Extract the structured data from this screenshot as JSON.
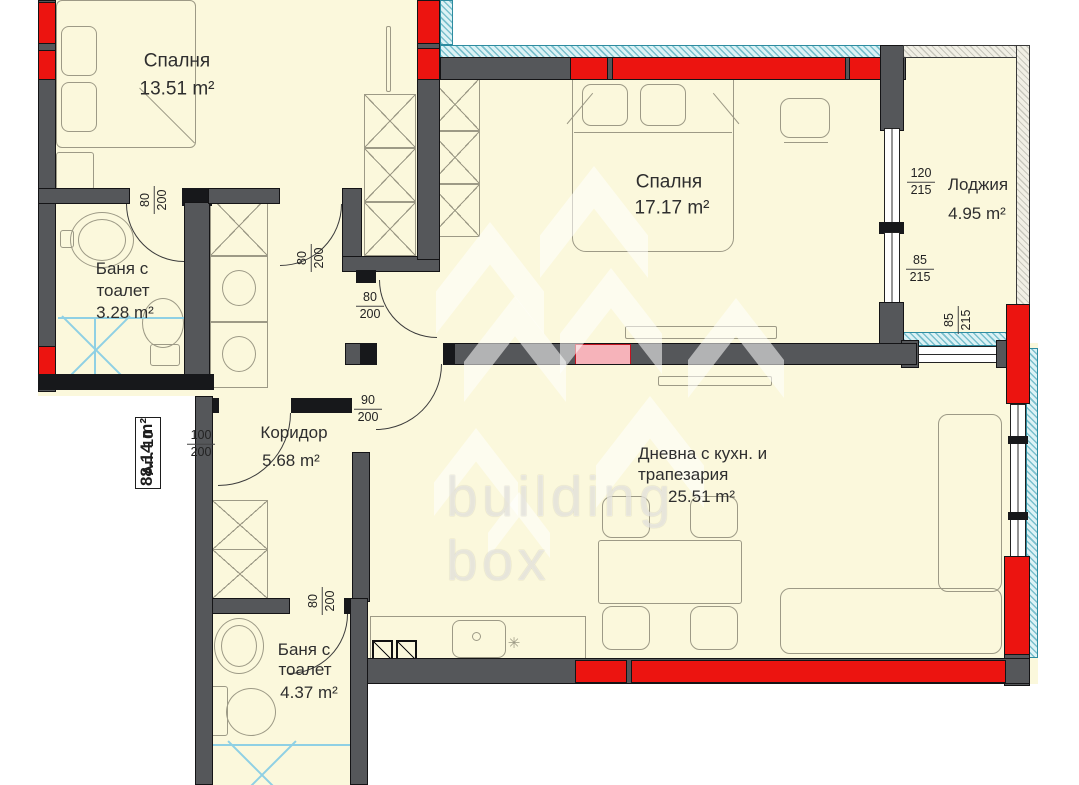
{
  "title": "Апартамент 10 — разпределение",
  "colors": {
    "floor": "#FBF8DC",
    "wall_gray": "#55575A",
    "column_red": "#EC1410",
    "insulation_teal": "#2E8CA0",
    "highlight_pink": "#F6B3BA",
    "plumbing_blue": "#8FD0E4"
  },
  "apartment": {
    "number": "Ап. 10",
    "area": "88.14 m²"
  },
  "rooms": [
    {
      "name": "Спалня",
      "area": "13.51 m²"
    },
    {
      "name": "Спалня",
      "area": "17.17 m²"
    },
    {
      "name": "Лоджия",
      "area": "4.95 m²"
    },
    {
      "name_line1": "Баня с",
      "name_line2": "тоалет",
      "area": "3.28 m²"
    },
    {
      "name": "Коридор",
      "area": "5.68 m²"
    },
    {
      "name_line1": "Дневна с кухн. и",
      "name_line2": "трапезария",
      "area": "25.51 m²"
    },
    {
      "name_line1": "Баня с",
      "name_line2": "тоалет",
      "area": "4.37 m²"
    }
  ],
  "dimensions": [
    {
      "w": "80",
      "h": "200"
    },
    {
      "w": "80",
      "h": "200"
    },
    {
      "w": "80",
      "h": "200"
    },
    {
      "w": "90",
      "h": "200"
    },
    {
      "w": "100",
      "h": "200"
    },
    {
      "w": "80",
      "h": "200"
    },
    {
      "w": "120",
      "h": "215"
    },
    {
      "w": "85",
      "h": "215"
    },
    {
      "w": "85",
      "h": "215"
    }
  ],
  "watermark": {
    "line1": "building",
    "line2": "box"
  }
}
